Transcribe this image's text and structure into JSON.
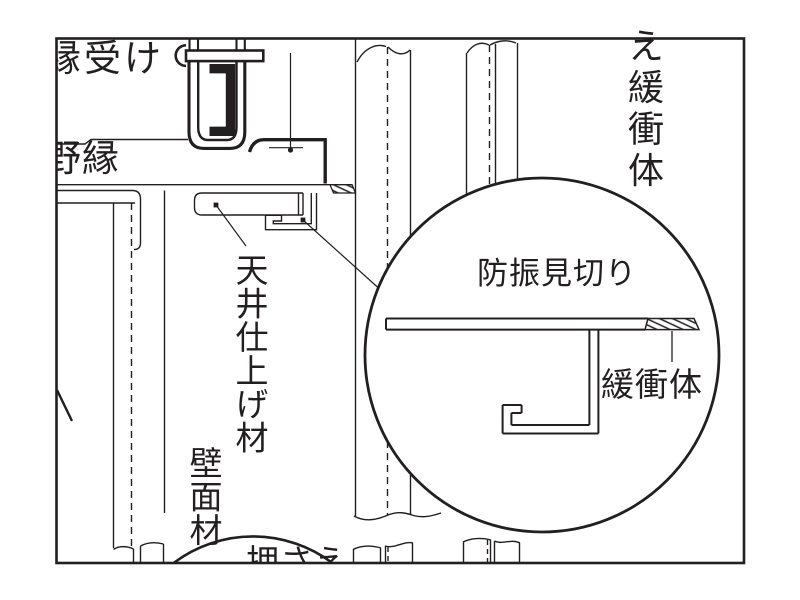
{
  "colors": {
    "line": "#231f20",
    "background": "#ffffff"
  },
  "labels": {
    "edge_receiver": "縁受け",
    "furring": "野縁",
    "ceiling_finish_material": "天井仕上げ材",
    "wall_material": "壁面材",
    "presser": "押さえ",
    "presser_buffer_column": "え緩衝体",
    "vibration_isolation_trim": "防振見切り",
    "buffer": "緩衝体"
  }
}
